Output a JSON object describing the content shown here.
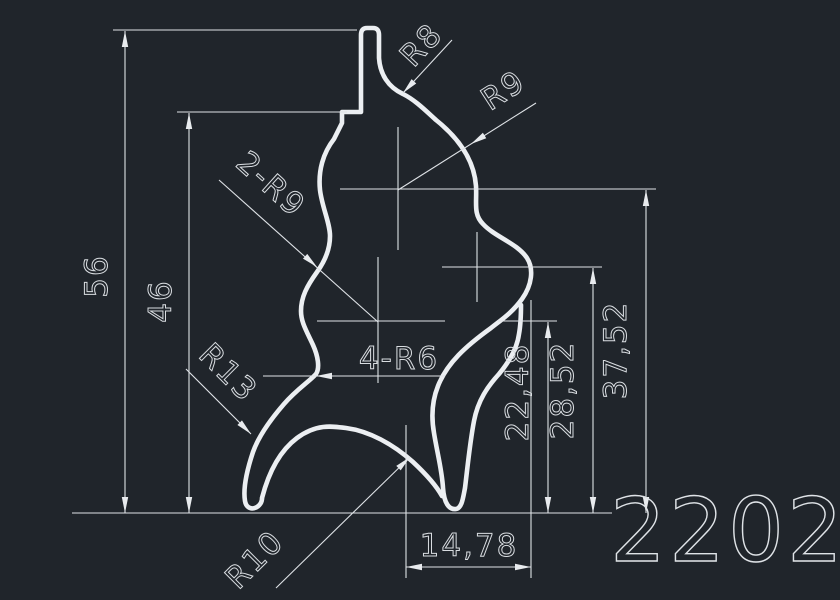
{
  "canvas": {
    "background_color": "#20252b",
    "line_color": "#e9ecef",
    "description": "CAD profile cross-section drawing"
  },
  "part_number": "2202",
  "dimensions": {
    "total_height": "56",
    "step_height": "46",
    "center_height_top": "37,52",
    "center_height_mid": "28,52",
    "center_height_low": "22,48",
    "width_offset": "14,78"
  },
  "radius_labels": {
    "r8": "R8",
    "r9": "R9",
    "double_r9": "2-R9",
    "quad_r6": "4-R6",
    "r13": "R13",
    "r10": "R10"
  }
}
